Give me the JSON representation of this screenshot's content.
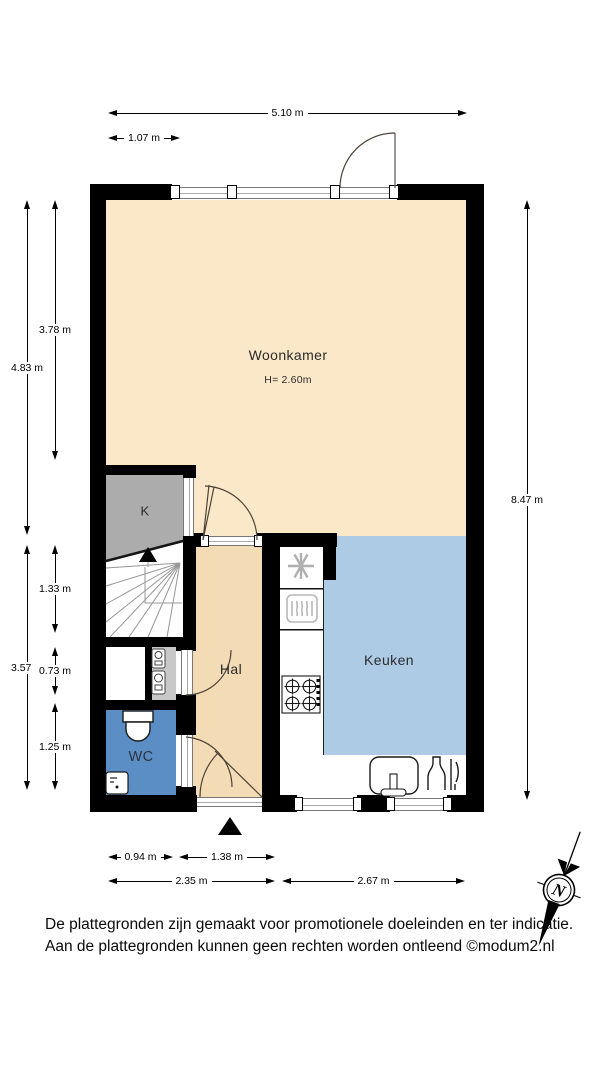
{
  "plan": {
    "rooms": {
      "woonkamer": {
        "label": "Woonkamer",
        "height_note": "H= 2.60m",
        "floor_color": "#FBE8C9"
      },
      "keuken": {
        "label": "Keuken",
        "floor_color": "#AECBE5"
      },
      "hal": {
        "label": "Hal",
        "floor_color": "#F3DBB6"
      },
      "wc": {
        "label": "WC",
        "floor_color": "#5C8EC6"
      },
      "kast": {
        "label": "K",
        "floor_color": "#ACACAC"
      }
    },
    "dimensions": [
      {
        "id": "d-510",
        "label": "5.10 m"
      },
      {
        "id": "d-107",
        "label": "1.07 m"
      },
      {
        "id": "d-483",
        "label": "4.83 m"
      },
      {
        "id": "d-378",
        "label": "3.78 m"
      },
      {
        "id": "d-133",
        "label": "1.33 m"
      },
      {
        "id": "d-357",
        "label": "3.57 m"
      },
      {
        "id": "d-073",
        "label": "0.73 m"
      },
      {
        "id": "d-125",
        "label": "1.25 m"
      },
      {
        "id": "d-847",
        "label": "8.47 m"
      },
      {
        "id": "d-094",
        "label": "0.94 m"
      },
      {
        "id": "d-138",
        "label": "1.38 m"
      },
      {
        "id": "d-235",
        "label": "2.35 m"
      },
      {
        "id": "d-267",
        "label": "2.67 m"
      }
    ],
    "fixtures": [
      "staircase",
      "stairs-up-arrow",
      "entrance-marker",
      "entry-door",
      "front-door",
      "closet-door",
      "wc-door",
      "toilet",
      "hand-basin",
      "boiler-unit",
      "snowflake-appliance-icon",
      "oven-icon",
      "gas-hob-icon",
      "kitchen-sink",
      "dish-rack-icon",
      "window-glazing"
    ],
    "colors": {
      "wall": "#000000",
      "woonkamer_floor": "#FBE8C9",
      "hal_floor": "#F3DBB6",
      "keuken_floor": "#AECBE5",
      "wc_floor": "#5C8EC6",
      "kast_floor": "#ACACAC",
      "cv_closet_floor": "#C8C8C8"
    }
  },
  "compass": {
    "north_label": "N"
  },
  "footer": {
    "line1": "De plattegronden zijn gemaakt voor promotionele doeleinden en ter indicatie.",
    "line2": "Aan de plattegronden kunnen geen rechten worden ontleend ©modum2.nl"
  }
}
